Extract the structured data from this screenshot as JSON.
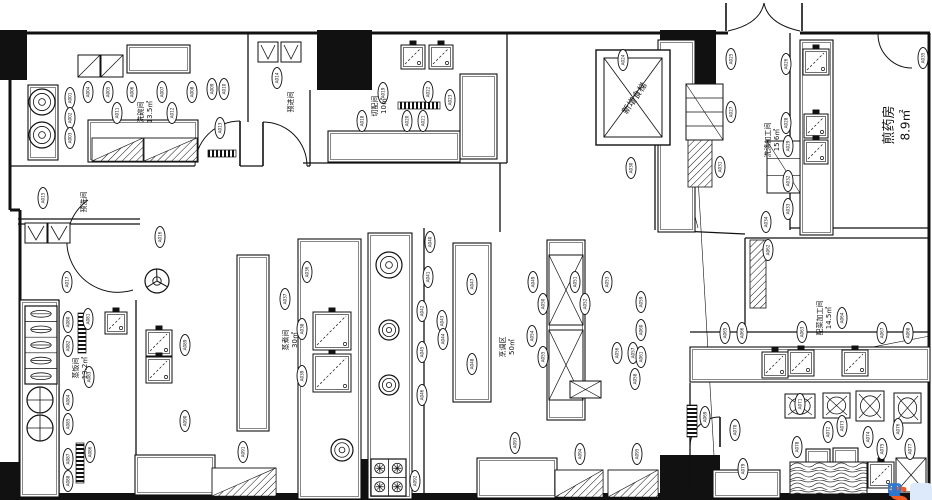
{
  "plan": {
    "background": "#ffffff",
    "ink": "#111111",
    "rooms": [
      {
        "name": "洗碗间",
        "area": "13.5㎡",
        "x": 143,
        "y": 112,
        "rot": -90,
        "fs": 7
      },
      {
        "name": "预进间",
        "area": "",
        "x": 293,
        "y": 102,
        "rot": -90,
        "fs": 7
      },
      {
        "name": "预洗间",
        "area": "",
        "x": 86,
        "y": 202,
        "rot": -90,
        "fs": 7
      },
      {
        "name": "切配间",
        "area": "10㎡",
        "x": 377,
        "y": 106,
        "rot": -90,
        "fs": 7
      },
      {
        "name": "洗涤加工间",
        "area": "15.6㎡",
        "x": 770,
        "y": 140,
        "rot": -90,
        "fs": 7
      },
      {
        "name": "煎药房",
        "area": "8.9㎡",
        "x": 893,
        "y": 125,
        "rot": -90,
        "fs": 13
      },
      {
        "name": "配菜加工间",
        "area": "14.5㎡",
        "x": 822,
        "y": 318,
        "rot": -90,
        "fs": 7
      },
      {
        "name": "烹调区",
        "area": "50㎡",
        "x": 505,
        "y": 347,
        "rot": -90,
        "fs": 7
      },
      {
        "name": "蒸煮间",
        "area": "30㎡",
        "x": 288,
        "y": 340,
        "rot": -90,
        "fs": 7
      },
      {
        "name": "蒸饭间",
        "area": "13.2㎡",
        "x": 78,
        "y": 368,
        "rot": -90,
        "fs": 7
      },
      {
        "name": "新增食梯",
        "area": "",
        "x": 637,
        "y": 100,
        "rot": -55,
        "fs": 9
      }
    ],
    "pill_code_format": "A###",
    "pills": [
      [
        70,
        98
      ],
      [
        70,
        118
      ],
      [
        70,
        138
      ],
      [
        88,
        92
      ],
      [
        108,
        92
      ],
      [
        132,
        92
      ],
      [
        162,
        92
      ],
      [
        192,
        92
      ],
      [
        212,
        89
      ],
      [
        224,
        89
      ],
      [
        117,
        113
      ],
      [
        172,
        113
      ],
      [
        220,
        128
      ],
      [
        277,
        78
      ],
      [
        43,
        198
      ],
      [
        160,
        237
      ],
      [
        67,
        282
      ],
      [
        362,
        121
      ],
      [
        383,
        93
      ],
      [
        407,
        121
      ],
      [
        423,
        121
      ],
      [
        428,
        92
      ],
      [
        450,
        100
      ],
      [
        623,
        60
      ],
      [
        731,
        59
      ],
      [
        786,
        64
      ],
      [
        731,
        112
      ],
      [
        786,
        123
      ],
      [
        788,
        146
      ],
      [
        631,
        168
      ],
      [
        720,
        167
      ],
      [
        788,
        181
      ],
      [
        788,
        209
      ],
      [
        766,
        222
      ],
      [
        923,
        58
      ],
      [
        307,
        272
      ],
      [
        285,
        299
      ],
      [
        302,
        329
      ],
      [
        302,
        376
      ],
      [
        430,
        242
      ],
      [
        428,
        277
      ],
      [
        422,
        311
      ],
      [
        442,
        321
      ],
      [
        443,
        339
      ],
      [
        422,
        352
      ],
      [
        422,
        395
      ],
      [
        472,
        284
      ],
      [
        472,
        364
      ],
      [
        533,
        282
      ],
      [
        543,
        304
      ],
      [
        575,
        282
      ],
      [
        585,
        304
      ],
      [
        607,
        282
      ],
      [
        532,
        336
      ],
      [
        543,
        357
      ],
      [
        617,
        353
      ],
      [
        633,
        353
      ],
      [
        635,
        379
      ],
      [
        641,
        302
      ],
      [
        641,
        330
      ],
      [
        641,
        357
      ],
      [
        768,
        250
      ],
      [
        802,
        332
      ],
      [
        842,
        318
      ],
      [
        725,
        333
      ],
      [
        742,
        333
      ],
      [
        882,
        333
      ],
      [
        908,
        333
      ],
      [
        705,
        417
      ],
      [
        735,
        430
      ],
      [
        800,
        404
      ],
      [
        828,
        432
      ],
      [
        842,
        426
      ],
      [
        868,
        437
      ],
      [
        882,
        449
      ],
      [
        898,
        429
      ],
      [
        910,
        449
      ],
      [
        797,
        447
      ],
      [
        743,
        469
      ],
      [
        68,
        322
      ],
      [
        88,
        319
      ],
      [
        68,
        346
      ],
      [
        89,
        377
      ],
      [
        68,
        400
      ],
      [
        68,
        424
      ],
      [
        90,
        452
      ],
      [
        68,
        459
      ],
      [
        68,
        481
      ],
      [
        185,
        345
      ],
      [
        185,
        421
      ],
      [
        243,
        452
      ],
      [
        415,
        481
      ],
      [
        515,
        443
      ],
      [
        580,
        454
      ],
      [
        637,
        454
      ]
    ],
    "outer": [
      [
        10,
        33,
        728,
        33
      ],
      [
        800,
        33,
        930,
        33
      ],
      [
        929,
        33,
        929,
        496
      ],
      [
        10,
        33,
        10,
        210
      ],
      [
        20,
        210,
        20,
        496
      ],
      [
        10,
        210,
        20,
        210
      ]
    ],
    "bottom_bar": [
      20,
      493,
      910,
      7
    ],
    "blocks": [
      [
        0,
        30,
        27,
        50
      ],
      [
        317,
        30,
        55,
        60
      ],
      [
        660,
        30,
        56,
        55
      ],
      [
        0,
        462,
        25,
        38
      ],
      [
        317,
        459,
        54,
        39
      ],
      [
        660,
        455,
        60,
        45
      ]
    ],
    "walls": [
      [
        10,
        166,
        195,
        166
      ],
      [
        240,
        166,
        263,
        166
      ],
      [
        307,
        166,
        310,
        166
      ],
      [
        18,
        219,
        140,
        219
      ],
      [
        18,
        224,
        140,
        224
      ],
      [
        248,
        33,
        248,
        122
      ],
      [
        310,
        90,
        310,
        166
      ],
      [
        507,
        33,
        507,
        163
      ],
      [
        303,
        163,
        507,
        163
      ],
      [
        655,
        85,
        655,
        230
      ],
      [
        790,
        33,
        790,
        230
      ],
      [
        790,
        228,
        930,
        228
      ],
      [
        745,
        238,
        930,
        238
      ],
      [
        745,
        238,
        745,
        332
      ],
      [
        690,
        332,
        930,
        332
      ],
      [
        136,
        300,
        136,
        493
      ],
      [
        59,
        300,
        59,
        496
      ],
      [
        20,
        300,
        59,
        300
      ],
      [
        424,
        228,
        424,
        496
      ],
      [
        690,
        383,
        690,
        493
      ],
      [
        500,
        163,
        500,
        232
      ],
      [
        660,
        230,
        745,
        234
      ]
    ],
    "diags": [
      [
        697,
        160,
        716,
        490
      ],
      [
        700,
        380,
        930,
        336
      ],
      [
        662,
        88,
        698,
        228
      ]
    ],
    "doors": [
      "M728,31 Q760,24 764,3",
      "M800,31 Q768,24 764,3",
      "M195,166 A45,45 0 0 1 240,121",
      "M307,166 A44,44 0 0 0 263,122",
      "M88,200 A51,51 0 0 0 133,290",
      "M878,34 A34,34 0 0 0 912,68",
      "M690,447 A30,30 0 0 1 720,417"
    ],
    "door_leaves": [
      [
        240,
        121,
        240,
        166
      ],
      [
        263,
        122,
        263,
        166
      ],
      [
        720,
        417,
        720,
        447
      ],
      [
        726,
        3,
        726,
        31
      ],
      [
        802,
        3,
        802,
        31
      ]
    ],
    "equipment": {
      "sinks": [
        [
          413,
          57,
          24
        ],
        [
          441,
          57,
          24
        ],
        [
          816,
          62,
          26
        ],
        [
          816,
          126,
          24
        ],
        [
          816,
          152,
          24
        ],
        [
          159,
          343,
          26
        ],
        [
          159,
          370,
          26
        ],
        [
          116,
          323,
          22
        ],
        [
          775,
          365,
          26
        ],
        [
          801,
          363,
          26
        ],
        [
          855,
          363,
          26
        ],
        [
          881,
          475,
          26
        ],
        [
          332,
          331,
          38
        ],
        [
          332,
          373,
          38
        ]
      ],
      "vboxes": [
        [
          25,
          223,
          22,
          20
        ],
        [
          48,
          223,
          22,
          20
        ],
        [
          258,
          42,
          20,
          20
        ],
        [
          281,
          42,
          20,
          20
        ]
      ],
      "xrects": [
        [
          549,
          255,
          34,
          70
        ],
        [
          549,
          330,
          34,
          70
        ],
        [
          570,
          381,
          31,
          17
        ],
        [
          896,
          458,
          30,
          34
        ]
      ],
      "diagboxes": [
        [
          78,
          55,
          22,
          22
        ],
        [
          101,
          55,
          22,
          22
        ]
      ],
      "rings": [
        [
          42,
          102,
          13
        ],
        [
          42,
          135,
          13
        ],
        [
          389,
          265,
          13
        ],
        [
          389,
          330,
          10
        ],
        [
          389,
          385,
          10
        ],
        [
          342,
          450,
          11
        ]
      ],
      "pots": [
        [
          40,
          400,
          13
        ],
        [
          40,
          428,
          13
        ]
      ],
      "wheels": [
        [
          157,
          281,
          12
        ]
      ],
      "steamers": [
        [
          25,
          306,
          32,
          78,
          5
        ]
      ],
      "stoves": [
        [
          371,
          459,
          35,
          37
        ]
      ],
      "grates_h": [
        [
          398,
          102,
          42,
          7
        ],
        [
          208,
          150,
          28,
          7
        ]
      ],
      "grates_v": [
        [
          78,
          313,
          8,
          40
        ],
        [
          76,
          443,
          8,
          40
        ],
        [
          687,
          405,
          10,
          32
        ]
      ],
      "hatch_rects": [
        [
          750,
          240,
          16,
          68
        ],
        [
          688,
          140,
          24,
          47
        ]
      ],
      "hatch_tris": [
        [
          92,
          138,
          51,
          23
        ],
        [
          144,
          138,
          53,
          23
        ],
        [
          212,
          468,
          64,
          28
        ],
        [
          555,
          470,
          48,
          27
        ],
        [
          608,
          470,
          50,
          27
        ]
      ],
      "wood_tables": [
        [
          790,
          462,
          77,
          32
        ]
      ],
      "shelves": [
        [
          686,
          84,
          37,
          56,
          4
        ],
        [
          767,
          141,
          33,
          52,
          3
        ]
      ],
      "tables": [
        [
          237,
          255,
          32,
          176
        ],
        [
          298,
          239,
          63,
          260
        ],
        [
          368,
          233,
          44,
          266
        ],
        [
          453,
          243,
          38,
          159
        ],
        [
          547,
          240,
          38,
          180
        ],
        [
          690,
          347,
          240,
          35
        ],
        [
          328,
          131,
          132,
          31
        ],
        [
          460,
          74,
          37,
          85
        ],
        [
          658,
          40,
          37,
          192
        ],
        [
          800,
          40,
          33,
          195
        ],
        [
          28,
          85,
          30,
          75
        ],
        [
          88,
          120,
          110,
          42
        ],
        [
          20,
          300,
          39,
          197
        ],
        [
          127,
          45,
          63,
          28
        ],
        [
          806,
          449,
          24,
          26
        ],
        [
          833,
          448,
          25,
          26
        ],
        [
          713,
          470,
          67,
          28
        ],
        [
          135,
          455,
          80,
          40
        ],
        [
          477,
          458,
          80,
          40
        ]
      ],
      "bins": [
        [
          785,
          394,
          30,
          24
        ],
        [
          823,
          393,
          27,
          25
        ],
        [
          856,
          391,
          28,
          30
        ],
        [
          894,
          393,
          27,
          30
        ]
      ],
      "elevator": {
        "x": 596,
        "y": 50,
        "w": 74,
        "h": 95
      }
    },
    "watermark": {
      "logo_text": "S",
      "logo_color": "#F05A23",
      "bar_color": "#ddeafc",
      "icon_color": "#2E77D0",
      "icons": [
        "chat",
        "user",
        "pause",
        "mic"
      ]
    }
  }
}
